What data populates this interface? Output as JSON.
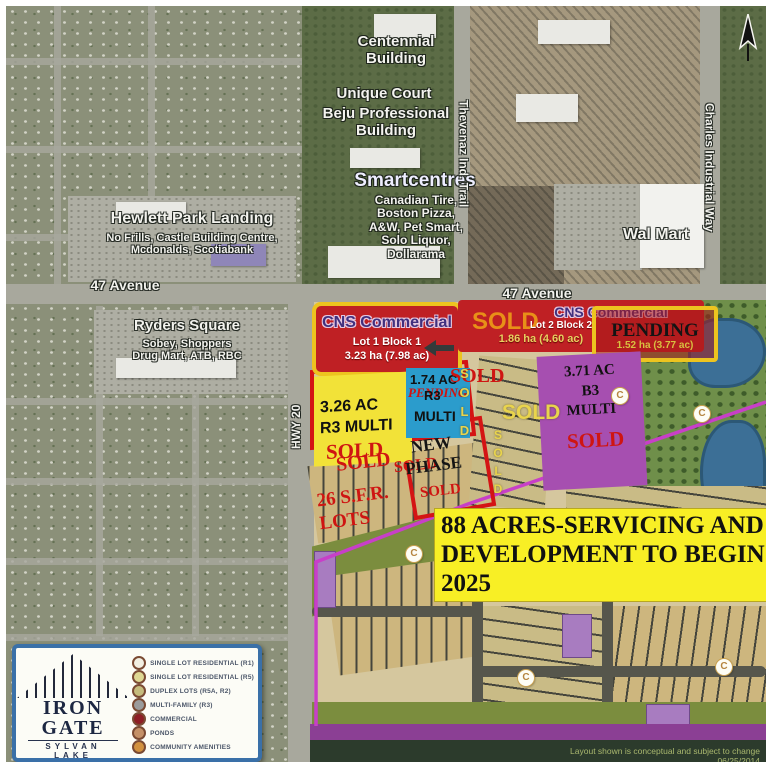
{
  "labels": {
    "centennial": "Centennial\nBuilding",
    "unique_court": "Unique Court",
    "beju": "Beju Professional\nBuilding",
    "smartcentres": "Smartcentres",
    "smartcentres_tenants": "Canadian Tire,\nBoston Pizza,\nA&W, Pet Smart,\nSolo Liquor,\nDollarama",
    "hewlett": "Hewlett Park Landing",
    "hewlett_tenants": "No Frills, Castle Building Centre,\nMcdonalds, Scotiabank",
    "ryders": "Ryders Square",
    "ryders_tenants": "Sobey, Shoppers\nDrug Mart, ATB, RBC",
    "walmart": "Wal Mart",
    "avenue_47": "47 Avenue",
    "hwy_20": "HWY 20",
    "thevenaz": "Thevenaz Ind. Trail",
    "charles": "Charles Industrial Way"
  },
  "parcels": {
    "cns1": {
      "name": "CNS Commercial",
      "lot": "Lot 1 Block 1",
      "area": "3.23 ha (7.98 ac)"
    },
    "cns2": {
      "sold": "SOLD",
      "name": "CNS Commercial",
      "lot": "Lot 2 Block 2",
      "area": "1.86 ha (4.60 ac)"
    },
    "pending_lot": {
      "status": "PENDING",
      "area": "1.52 ha (3.77 ac)"
    },
    "r3_multi": {
      "text": "3.26 AC\nR3 MULTI",
      "status": "SOLD"
    },
    "r4_multi": {
      "area": "1.74 AC",
      "pending": "PENDING",
      "zone": "R3",
      "multi": "MULTI"
    },
    "b3_multi": {
      "text": "3.71 AC\nB3\nMULTI",
      "status": "SOLD"
    }
  },
  "marks": {
    "sold": "SOLD",
    "new_phase": "NEW\nPHASE",
    "sfr_lots": "26 S.F.R.\nLOTS",
    "amenity": "C"
  },
  "banner": {
    "text": "88 ACRES-SERVICING AND DEVELOPMENT TO BEGIN 2025"
  },
  "footer": {
    "disclaimer": "Layout shown is conceptual and subject to change 06/25/2014"
  },
  "legend": {
    "title": "IRON GATE",
    "subtitle": "SYLVAN LAKE",
    "items": [
      {
        "label": "SINGLE LOT RESIDENTIAL (R1)",
        "color": "#f2efe2"
      },
      {
        "label": "SINGLE LOT RESIDENTIAL (R5)",
        "color": "#ded793"
      },
      {
        "label": "DUPLEX LOTS (R5A, R2)",
        "color": "#c6bc7d"
      },
      {
        "label": "MULTI-FAMILY (R3)",
        "color": "#9b9b9b"
      },
      {
        "label": "COMMERCIAL",
        "color": "#8e1e25"
      },
      {
        "label": "PONDS",
        "color": "#c49067"
      },
      {
        "label": "COMMUNITY AMENITIES",
        "color": "#d2913f"
      }
    ]
  },
  "colors": {
    "sold_red": "#cf1512",
    "sold_yellow": "#e9d44c",
    "commercial_red": "#bf2024",
    "outline_yellow": "#edc41f",
    "parcel_yellow": "#f2e238",
    "parcel_blue": "#2b9ccc",
    "parcel_purple": "#a64fb0",
    "phase_boundary_magenta": "#c83fc8",
    "banner_yellow": "#f8ef25",
    "legend_border_blue": "#3a70a8"
  }
}
